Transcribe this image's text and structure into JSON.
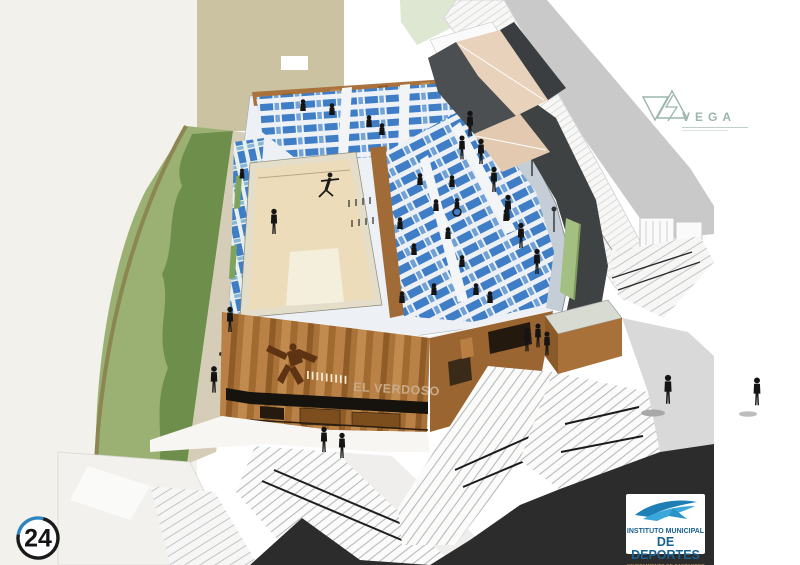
{
  "scene": {
    "type": "3d-architectural-render",
    "subject": "Sports pavilion with blue grandstands, skating rink, grand staircases and plaza",
    "building_sign": "EL VERDOSO"
  },
  "logos": {
    "vega": {
      "text": "VEGA",
      "color": "#9cb5ad"
    },
    "badge24": {
      "number": "24",
      "ring_blue": "#2e86c1",
      "ring_dark": "#1a1a1a",
      "digit_color": "#141414"
    },
    "imd": {
      "line1": "INSTITUTO MUNICIPAL",
      "line2": "DE DEPORTES",
      "line3": "AYUNTAMIENTO DE SANTANDER",
      "text_blue": "#19618f",
      "accent_tan": "#c49a5d",
      "swoosh_dark": "#1d7fb5",
      "swoosh_light": "#3aa6da"
    }
  },
  "palette": {
    "page_bg": "#ffffff",
    "left_margin": "#f3f1eb",
    "khaki_block": "#cbc2a2",
    "pale_green": "#dde7d1",
    "slope_green": "#9ab173",
    "slope_green_dark": "#6e8e4b",
    "path_tan": "#d6cdb8",
    "bowl_bg": "#edf1f5",
    "seat_blue": "#3f7ec6",
    "rink_beige": "#ecdcba",
    "rink_inner": "#f4eedc",
    "fascia_brown": "#a9713c",
    "facade_brown": "#b1783f",
    "concourse_gray": "#c5ced7",
    "wall_dark": "#3e4243",
    "hedge_green": "#a4bf82",
    "ramp_pink": "#e9d2bb",
    "gray_band": "#c9c9c9",
    "plaza_gray": "#d9d9d9",
    "ground_dark": "#2c2c2c",
    "figure_black": "#141414"
  }
}
